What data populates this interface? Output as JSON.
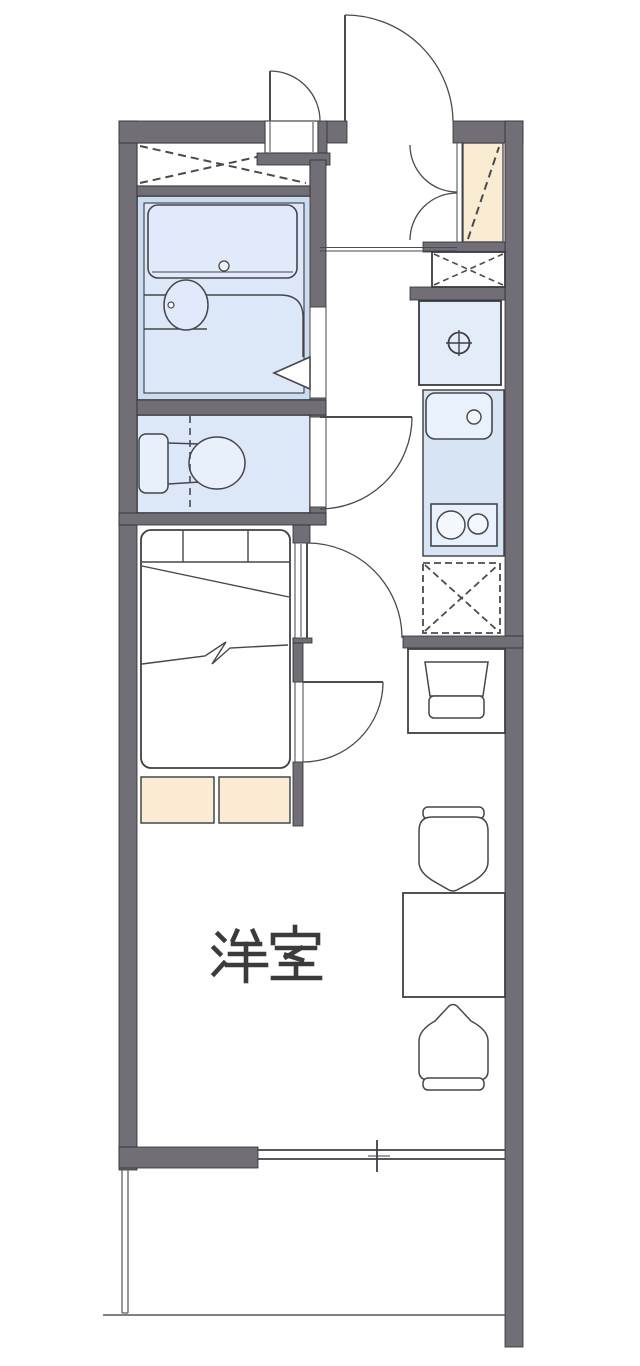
{
  "plan": {
    "rooms": {
      "main": {
        "label": "洋室"
      }
    },
    "colors": {
      "wall": "#716e76",
      "wet_area_fill": "#dce8f7",
      "wet_area_border_band": "#ccdcf0",
      "kitchen_fill": "#d7e4f4",
      "fixture_fill": "#e9f1fc",
      "storage_fill": "#f9ecd2",
      "line": "#46464c",
      "background": "#ffffff"
    },
    "icons": {
      "entrance_door": "quarter-arc swing",
      "interior_door": "quarter-arc swing",
      "folding_door_arrow": "triangle",
      "closet": "dashed X box",
      "shoe_cabinet": "cream box with dashed diagonal",
      "meter_box": "solid box with dashed X",
      "refrigerator_space": "dashed box with dashed X",
      "washing_machine_pan": "circle with cross",
      "kitchen_sink": "rounded box with drain circle",
      "stove": "box with two burner circles",
      "bathtub": "rounded rectangle with drain",
      "washbasin": "ellipse with tap dot",
      "toilet": "tank and bowl",
      "bed": "rounded rectangle with fold lines",
      "table": "rectangle",
      "chair": "rounded seat with back bar",
      "window": "double line with center tick",
      "balcony": "thin open outline"
    }
  }
}
